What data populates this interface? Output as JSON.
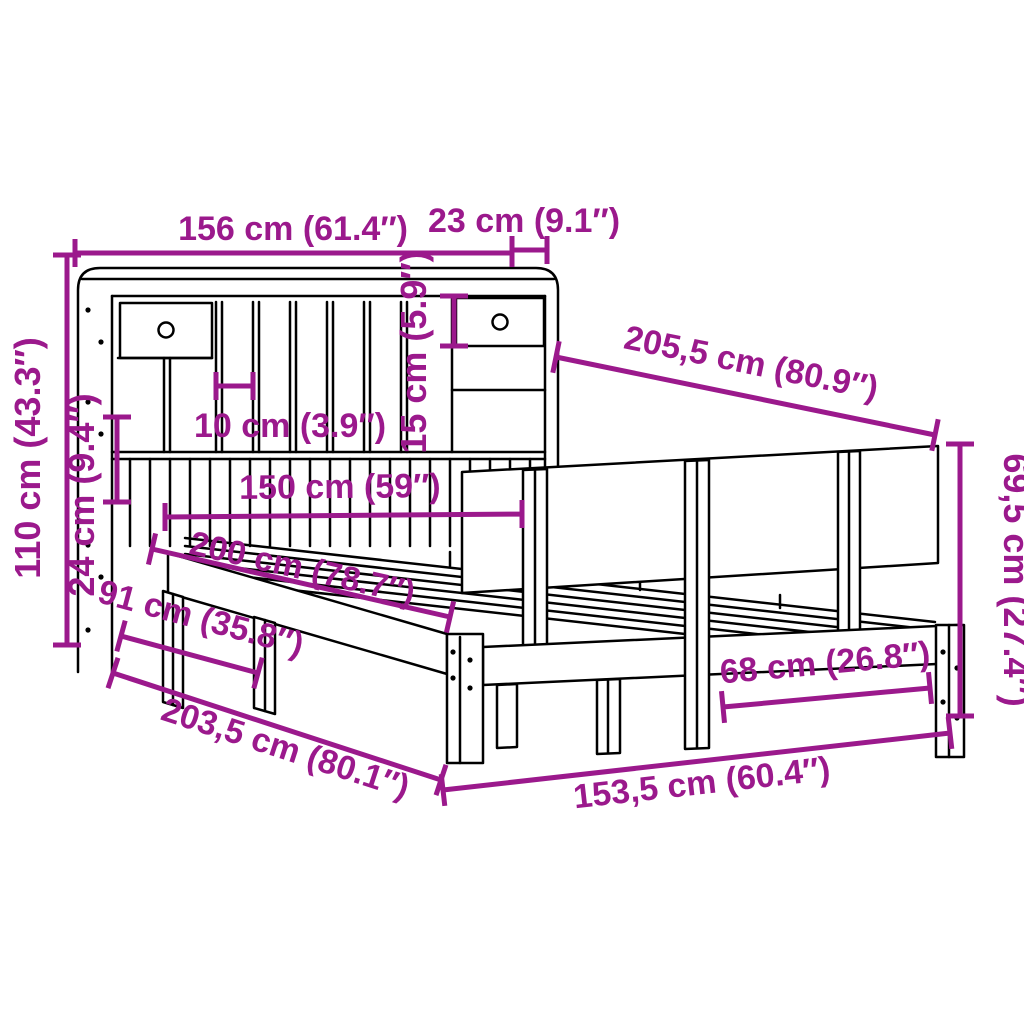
{
  "diagram": {
    "type": "product-dimension-diagram",
    "subject": "bed frame with bookcase headboard, side shelf panel and slatted base",
    "unit_style": "cm (inches)",
    "accent_color": "#9B198C",
    "line_color": "#000000",
    "background_color": "#FFFFFF",
    "dimensions": [
      {
        "id": "headboard-width",
        "label": "156 cm (61.4″)"
      },
      {
        "id": "headboard-depth",
        "label": "23 cm (9.1″)"
      },
      {
        "id": "total-length",
        "label": "205,5 cm (80.9″)"
      },
      {
        "id": "headboard-height",
        "label": "110 cm (43.3″)"
      },
      {
        "id": "lower-panel-height",
        "label": "24 cm (9.4″)"
      },
      {
        "id": "compartment-height",
        "label": "15 cm (5.9″)"
      },
      {
        "id": "slot-width",
        "label": "10 cm (3.9″)"
      },
      {
        "id": "mattress-width",
        "label": "150 cm (59″)"
      },
      {
        "id": "mattress-length",
        "label": "200 cm (78.7″)"
      },
      {
        "id": "frame-width-outer",
        "label": "91 cm (35.8″)"
      },
      {
        "id": "frame-length-outer",
        "label": "203,5 cm (80.1″)"
      },
      {
        "id": "side-length",
        "label": "153,5 cm (60.4″)"
      },
      {
        "id": "leg-spacing",
        "label": "68 cm (26.8″)"
      },
      {
        "id": "side-panel-height",
        "label": "69,5 cm (27.4″)"
      }
    ]
  }
}
